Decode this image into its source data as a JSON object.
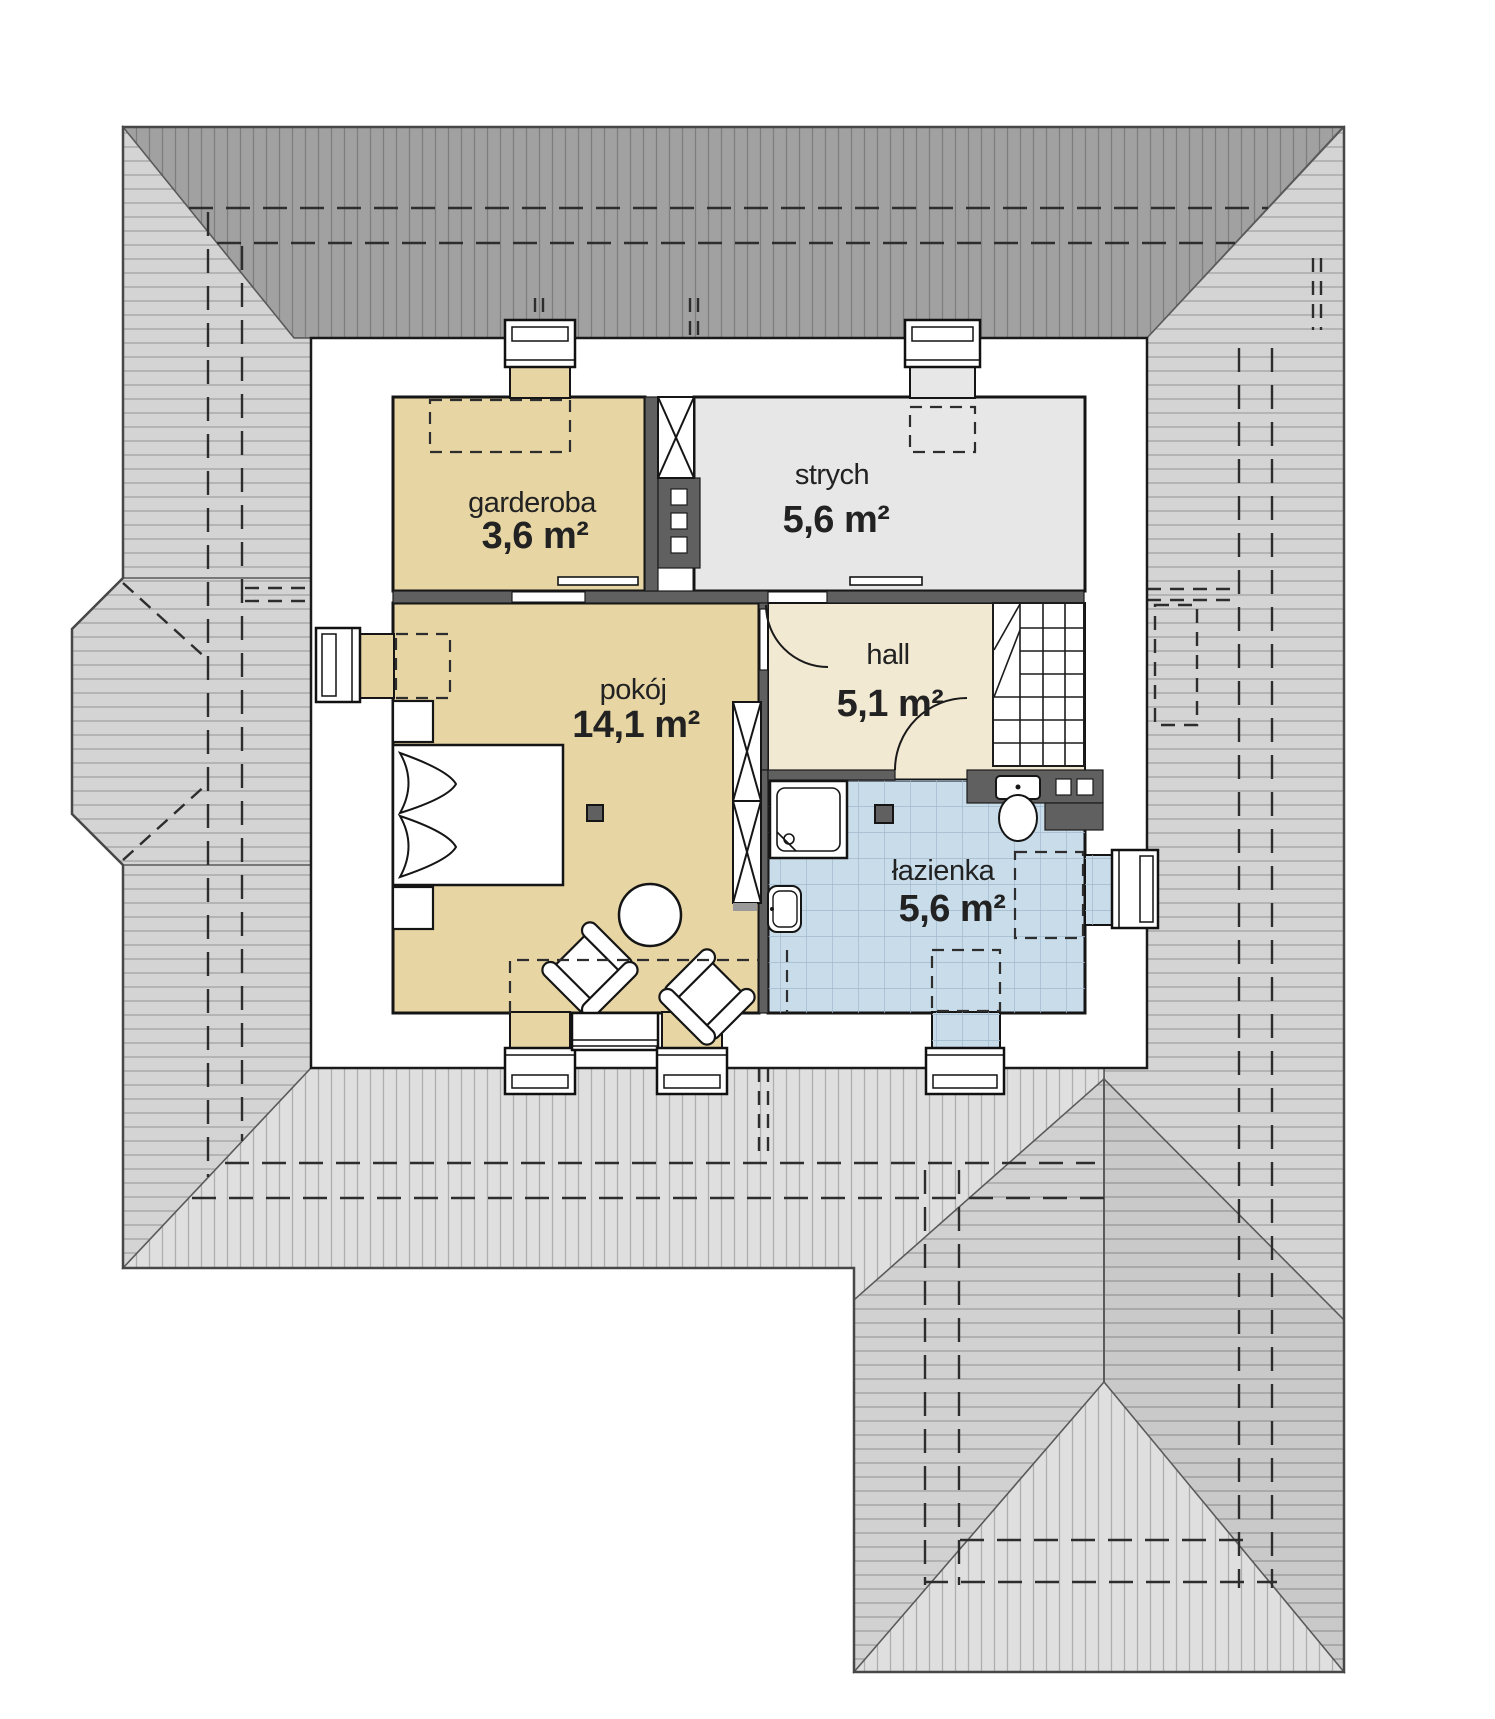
{
  "plan": {
    "title": "attic floor plan",
    "rooms": [
      {
        "key": "garderoba",
        "label": "garderoba",
        "area": "3,6 m²",
        "floor_color": "#e7d6a4"
      },
      {
        "key": "strych",
        "label": "strych",
        "area": "5,6 m²",
        "floor_color": "#e7e7e7"
      },
      {
        "key": "pokoj",
        "label": "pokój",
        "area": "14,1 m²",
        "floor_color": "#e7d6a4"
      },
      {
        "key": "hall",
        "label": "hall",
        "area": "5,1 m²",
        "floor_color": "#f2e9d3"
      },
      {
        "key": "lazienka",
        "label": "łazienka",
        "area": "5,6 m²",
        "floor_color": "#c9dcea"
      }
    ],
    "palette": {
      "roof_dark": "#a1a1a1",
      "roof_light": "#d4d4d4",
      "roof_lighter": "#dfdfdf",
      "roof_medium": "#c9c9c9",
      "wall": "#606060",
      "tile_line": "#9fb9cd",
      "outline": "#1a1a1a"
    }
  }
}
